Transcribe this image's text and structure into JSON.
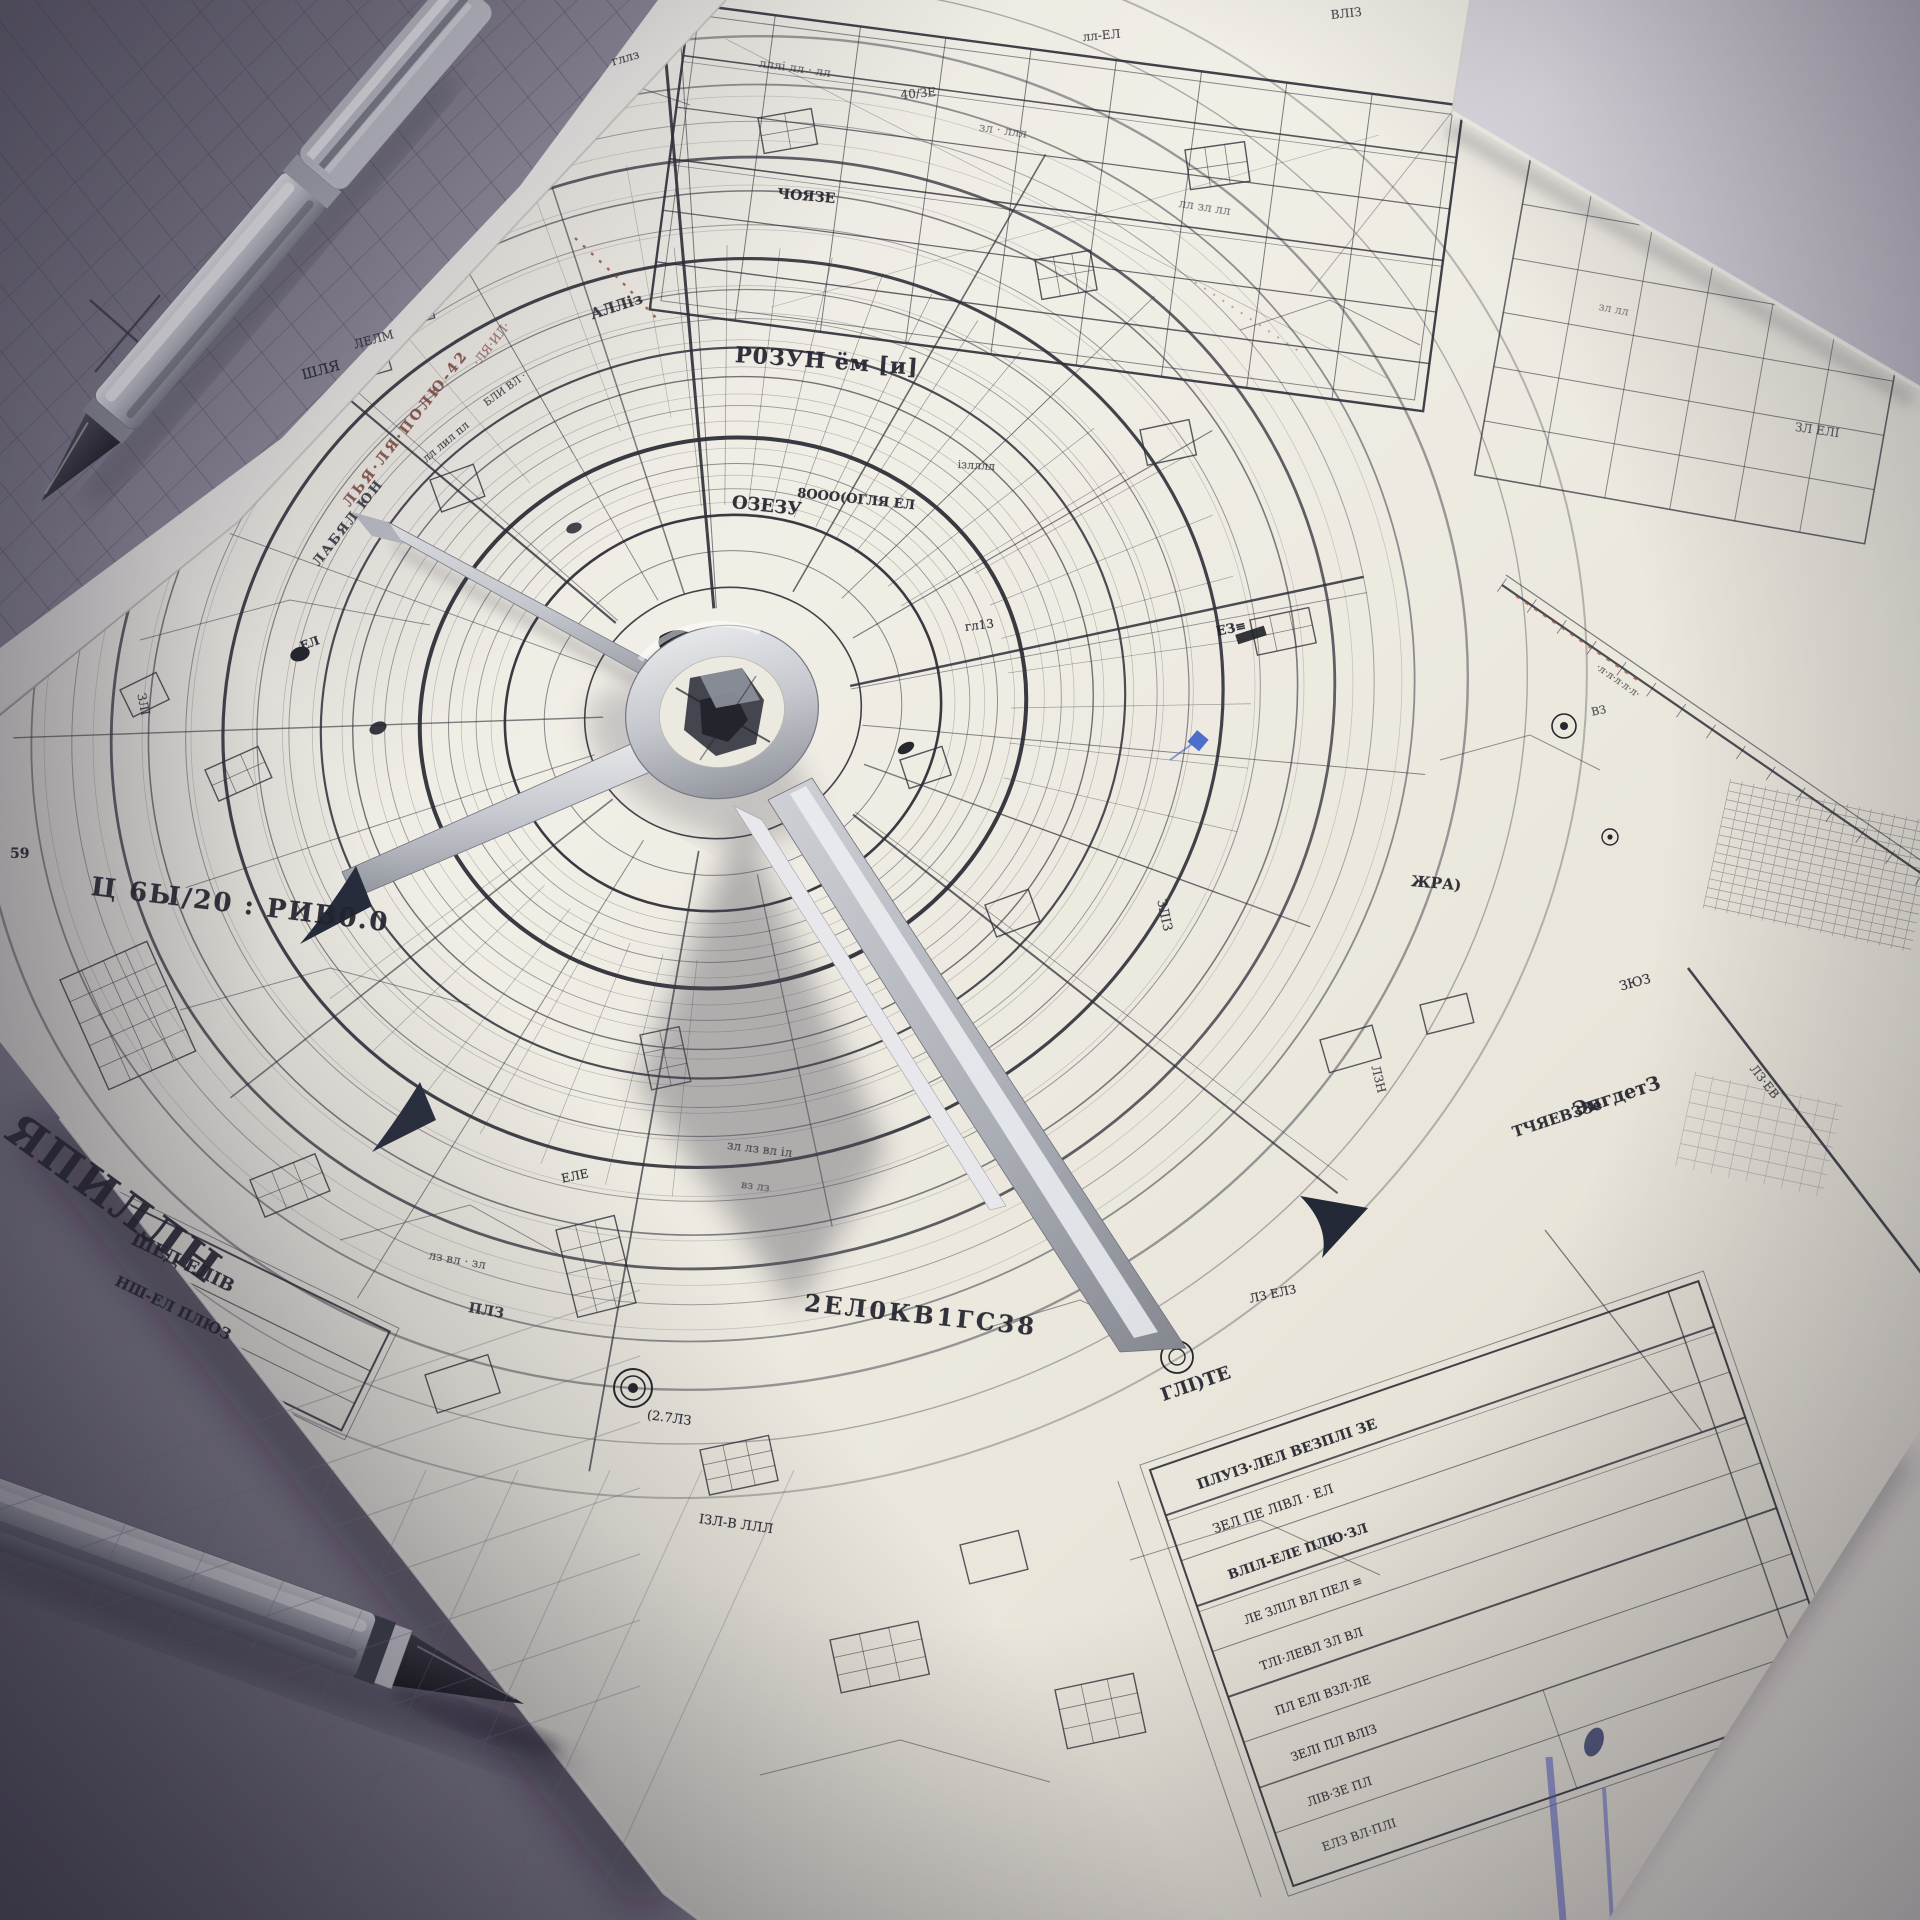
{
  "scene": {
    "subject": "photographic render of a hand-drawn radial blueprint on paper",
    "objects": [
      "white blueprint sheet with concentric radial plan",
      "metal drafting divider resting on hub",
      "chrome pen top-left",
      "chrome pen bottom-left",
      "grey grid sheet top-left",
      "legend table bottom-right"
    ]
  },
  "palette": {
    "desk": "#aaa6b2",
    "desk_dark": "#6e6a7a",
    "paper": "#ece9e1",
    "paper_shadowed": "#d9d4c9",
    "grey_sheet": "#8a8694",
    "ink": "#2e2f39",
    "accent_red": "#99503f",
    "accent_blue": "#3b62c9",
    "arrow_navy": "#262c3c",
    "metal_light": "#d9dadc",
    "metal_dark": "#8f939c",
    "pen_tip_black": "#17171c"
  },
  "annotations": [
    {
      "t": "Ц 6Ы/20 : РИВ0.0",
      "x": 93,
      "y": 872,
      "r": 7,
      "s": 26,
      "w": 700,
      "ls": 2
    },
    {
      "t": "ЯПИЛЛН",
      "x": 26,
      "y": 1104,
      "r": 36,
      "s": 44,
      "w": 800,
      "ls": 2
    },
    {
      "t": "ШЕД ЕЛІВ",
      "x": 137,
      "y": 1229,
      "r": 26,
      "s": 18,
      "w": 700
    },
    {
      "t": "НШ-ЕЛ ПЛЮЗ",
      "x": 120,
      "y": 1272,
      "r": 26,
      "s": 15,
      "w": 600
    },
    {
      "t": "2ЕЛ0КВ1ГС38",
      "x": 806,
      "y": 1288,
      "r": 6,
      "s": 24,
      "w": 700,
      "ls": 3
    },
    {
      "t": "Р0ЗУН ём [и]",
      "x": 736,
      "y": 342,
      "r": 4,
      "s": 22,
      "w": 700,
      "ls": 1
    },
    {
      "t": "ЧОЯЗЕ",
      "x": 778,
      "y": 186,
      "r": 5,
      "s": 14,
      "w": 600
    },
    {
      "t": "8ООО(ОГЛЯ ЕЛ",
      "x": 798,
      "y": 486,
      "r": 6,
      "s": 13,
      "w": 600
    },
    {
      "t": "ОЗЕЗУ",
      "x": 733,
      "y": 492,
      "r": 6,
      "s": 18,
      "w": 800
    },
    {
      "t": "ізлллл",
      "x": 958,
      "y": 458,
      "r": 3,
      "s": 11,
      "o": 0.75
    },
    {
      "t": "ЛЬЯ·ЛЯ·ПОЛЮ-42",
      "x": 340,
      "y": 500,
      "r": -52,
      "s": 14,
      "c": "#7d4437",
      "w": 600,
      "ls": 3,
      "o": 0.85
    },
    {
      "t": "ЛАБЯЛ ЮН",
      "x": 310,
      "y": 560,
      "r": -52,
      "s": 13,
      "c": "#3a3a44",
      "w": 600,
      "ls": 2
    },
    {
      "t": "·ЛЯ·ИЛ·",
      "x": 470,
      "y": 360,
      "r": -52,
      "s": 12,
      "c": "#8a4a3a",
      "o": 0.7
    },
    {
      "t": "59",
      "x": 10,
      "y": 846,
      "r": 0,
      "s": 14,
      "w": 600
    },
    {
      "t": "ЖРА)",
      "x": 1412,
      "y": 872,
      "r": 5,
      "s": 15,
      "w": 700
    },
    {
      "t": "ЗЮЗ",
      "x": 1618,
      "y": 980,
      "r": -15,
      "s": 13
    },
    {
      "t": "ЭпгдетЗ",
      "x": 1570,
      "y": 1100,
      "r": -18,
      "s": 19,
      "w": 700
    },
    {
      "t": "ТЧЯЕВЗЗе",
      "x": 1510,
      "y": 1124,
      "r": -18,
      "s": 15,
      "w": 600
    },
    {
      "t": "ГЛІ)ТЕ",
      "x": 1158,
      "y": 1386,
      "r": -19,
      "s": 18,
      "w": 700
    },
    {
      "t": "40/ЗЕ",
      "x": 900,
      "y": 88,
      "r": -5,
      "s": 12,
      "o": 0.8
    },
    {
      "t": "лл-ЕЛ",
      "x": 1082,
      "y": 30,
      "r": -5,
      "s": 12,
      "o": 0.8
    },
    {
      "t": "ВЛІЗ",
      "x": 1330,
      "y": 8,
      "r": -6,
      "s": 12,
      "o": 0.8
    },
    {
      "t": "гллз",
      "x": 610,
      "y": 55,
      "r": -16,
      "s": 12,
      "o": 0.8
    },
    {
      "t": "АЛЛіз",
      "x": 588,
      "y": 306,
      "r": -18,
      "s": 15,
      "w": 700,
      "o": 0.85
    },
    {
      "t": "лл лил пл",
      "x": 420,
      "y": 455,
      "r": -40,
      "s": 11,
      "o": 0.8
    },
    {
      "t": "БЛИ ВЛ ·",
      "x": 482,
      "y": 400,
      "r": -36,
      "s": 10,
      "o": 0.8
    },
    {
      "t": "ЗЛІ",
      "x": 148,
      "y": 692,
      "r": 78,
      "s": 12,
      "o": 0.85
    },
    {
      "t": "ШЛЯ",
      "x": 300,
      "y": 368,
      "r": -15,
      "s": 14
    },
    {
      "t": "ЛЕЛМ",
      "x": 352,
      "y": 338,
      "r": -15,
      "s": 12,
      "o": 0.8
    },
    {
      "t": "ЕЛ",
      "x": 298,
      "y": 640,
      "r": -20,
      "s": 12,
      "w": 700
    },
    {
      "t": "гл13",
      "x": 964,
      "y": 620,
      "r": -7,
      "s": 12
    },
    {
      "t": "ЕЗ≡",
      "x": 1215,
      "y": 625,
      "r": -12,
      "s": 13,
      "w": 700
    },
    {
      "t": "ЗЛІЗ",
      "x": 1168,
      "y": 898,
      "r": 78,
      "s": 13,
      "o": 0.85
    },
    {
      "t": "ЛЗН",
      "x": 1382,
      "y": 1064,
      "r": 76,
      "s": 12,
      "o": 0.8
    },
    {
      "t": "ВЗ",
      "x": 1590,
      "y": 706,
      "r": -12,
      "s": 11,
      "o": 0.8
    },
    {
      "t": "·л·л·л·л·л·",
      "x": 1600,
      "y": 662,
      "r": 35,
      "s": 10,
      "o": 0.7
    },
    {
      "t": "ЗЛ ЕЛІ",
      "x": 1796,
      "y": 420,
      "r": 8,
      "s": 12,
      "o": 0.7
    },
    {
      "t": "ЛЗ·ЕВ",
      "x": 1758,
      "y": 1062,
      "r": 52,
      "s": 12,
      "o": 0.8
    },
    {
      "t": "(2.7ЛЗ",
      "x": 648,
      "y": 1408,
      "r": 8,
      "s": 13
    },
    {
      "t": "ІЗЛ-В ЛЛЛ",
      "x": 700,
      "y": 1512,
      "r": 8,
      "s": 13
    },
    {
      "t": "ЛЗ ЕЛЗ",
      "x": 1248,
      "y": 1292,
      "r": -12,
      "s": 12
    },
    {
      "t": "ЕЛЕ",
      "x": 560,
      "y": 1172,
      "r": -12,
      "s": 12
    },
    {
      "t": "зл лз вл іл",
      "x": 728,
      "y": 1138,
      "r": 7,
      "s": 12,
      "o": 0.7
    },
    {
      "t": "вз лз",
      "x": 742,
      "y": 1178,
      "r": 7,
      "s": 11,
      "o": 0.6
    },
    {
      "t": "лз вл · зл",
      "x": 430,
      "y": 1248,
      "r": 10,
      "s": 12,
      "o": 0.7
    },
    {
      "t": "ПЛЗ",
      "x": 470,
      "y": 1300,
      "r": 10,
      "s": 14,
      "w": 700,
      "o": 0.85
    },
    {
      "t": "лллі лл · лл",
      "x": 760,
      "y": 56,
      "r": 8,
      "s": 12,
      "o": 0.6
    },
    {
      "t": "зл · ллл",
      "x": 980,
      "y": 120,
      "r": 8,
      "s": 12,
      "o": 0.55
    },
    {
      "t": "лл зл лл",
      "x": 1180,
      "y": 196,
      "r": 9,
      "s": 12,
      "o": 0.55
    },
    {
      "t": "зл лл",
      "x": 1600,
      "y": 300,
      "r": 11,
      "s": 11,
      "o": 0.5
    },
    {
      "t": "ПЛУІЗ·ЛЕЛ ВЕЗПЛІ ЗЕ",
      "x": 1195,
      "y": 1478,
      "r": -19,
      "s": 14,
      "w": 700
    },
    {
      "t": "ЗЕЛ ПЕ ЛІВЛ · ЕЛ",
      "x": 1211,
      "y": 1523,
      "r": -19,
      "s": 13
    },
    {
      "t": "ВЛІЛ-ЕЛЕ ПЛЮ·ЗЛ",
      "x": 1226,
      "y": 1569,
      "r": -19,
      "s": 13,
      "w": 600
    },
    {
      "t": "ЛЕ ЗЛІЛ ВЛ ПЕЛ ≡",
      "x": 1242,
      "y": 1614,
      "r": -19,
      "s": 12
    },
    {
      "t": "ТЛІ·ЛЕВЛ ЗЛ ВЛ",
      "x": 1258,
      "y": 1660,
      "r": -19,
      "s": 12
    },
    {
      "t": "ПЛ ЕЛІ ВЗЛ·ЛЕ",
      "x": 1273,
      "y": 1705,
      "r": -19,
      "s": 12
    },
    {
      "t": "ЗЕЛІ ПЛ ВЛІЗ",
      "x": 1289,
      "y": 1751,
      "r": -19,
      "s": 12
    },
    {
      "t": "ЛІВ·ЗЕ ПЛ",
      "x": 1305,
      "y": 1796,
      "r": -19,
      "s": 12,
      "o": 0.85
    },
    {
      "t": "ЕЛЗ ВЛ·ПЛІ",
      "x": 1320,
      "y": 1841,
      "r": -19,
      "s": 12,
      "o": 0.8
    }
  ]
}
